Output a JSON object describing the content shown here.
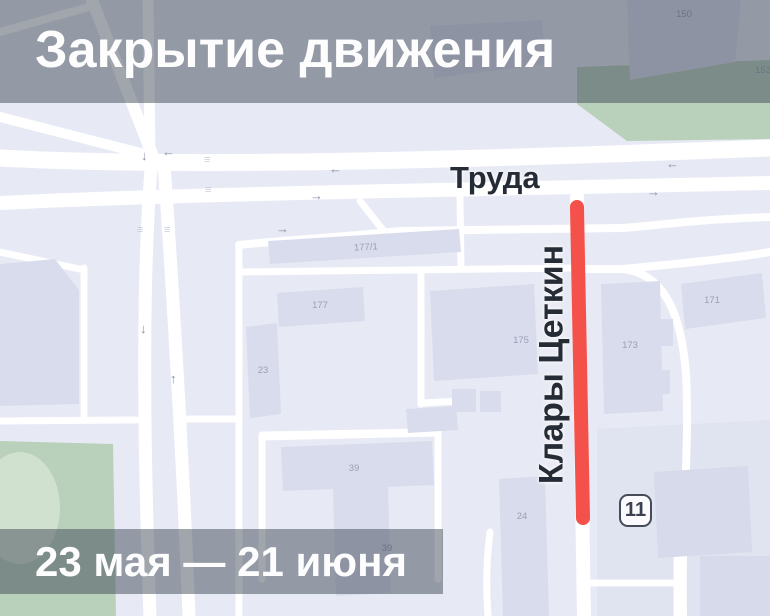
{
  "banners": {
    "title": "Закрытие движения",
    "dates": "23 мая — 21 июня"
  },
  "map": {
    "street_labels": {
      "horizontal": "Труда",
      "vertical": "Клары Цеткин"
    },
    "address_badge": "11",
    "building_labels": [
      {
        "text": "150"
      },
      {
        "text": "152"
      },
      {
        "text": "177/1"
      },
      {
        "text": "177"
      },
      {
        "text": "23"
      },
      {
        "text": "175"
      },
      {
        "text": "173"
      },
      {
        "text": "171"
      },
      {
        "text": "39"
      },
      {
        "text": "39"
      },
      {
        "text": "24"
      }
    ],
    "icons": {
      "arrow_left": "←",
      "arrow_right": "→",
      "arrow_up": "↑",
      "arrow_down": "↓",
      "crosswalk": "≡"
    },
    "colors": {
      "map_background": "#e7e9f4",
      "building_fill": "#d9dcec",
      "block_fill": "#e0e3f0",
      "road_fill": "#ffffff",
      "park_green": "#b9d0ba",
      "park_green_light": "#d0e1d0",
      "closure_red": "#f4514a",
      "banner_overlay": "rgba(58,66,82,0.48)",
      "street_label_color": "#262c36"
    }
  }
}
